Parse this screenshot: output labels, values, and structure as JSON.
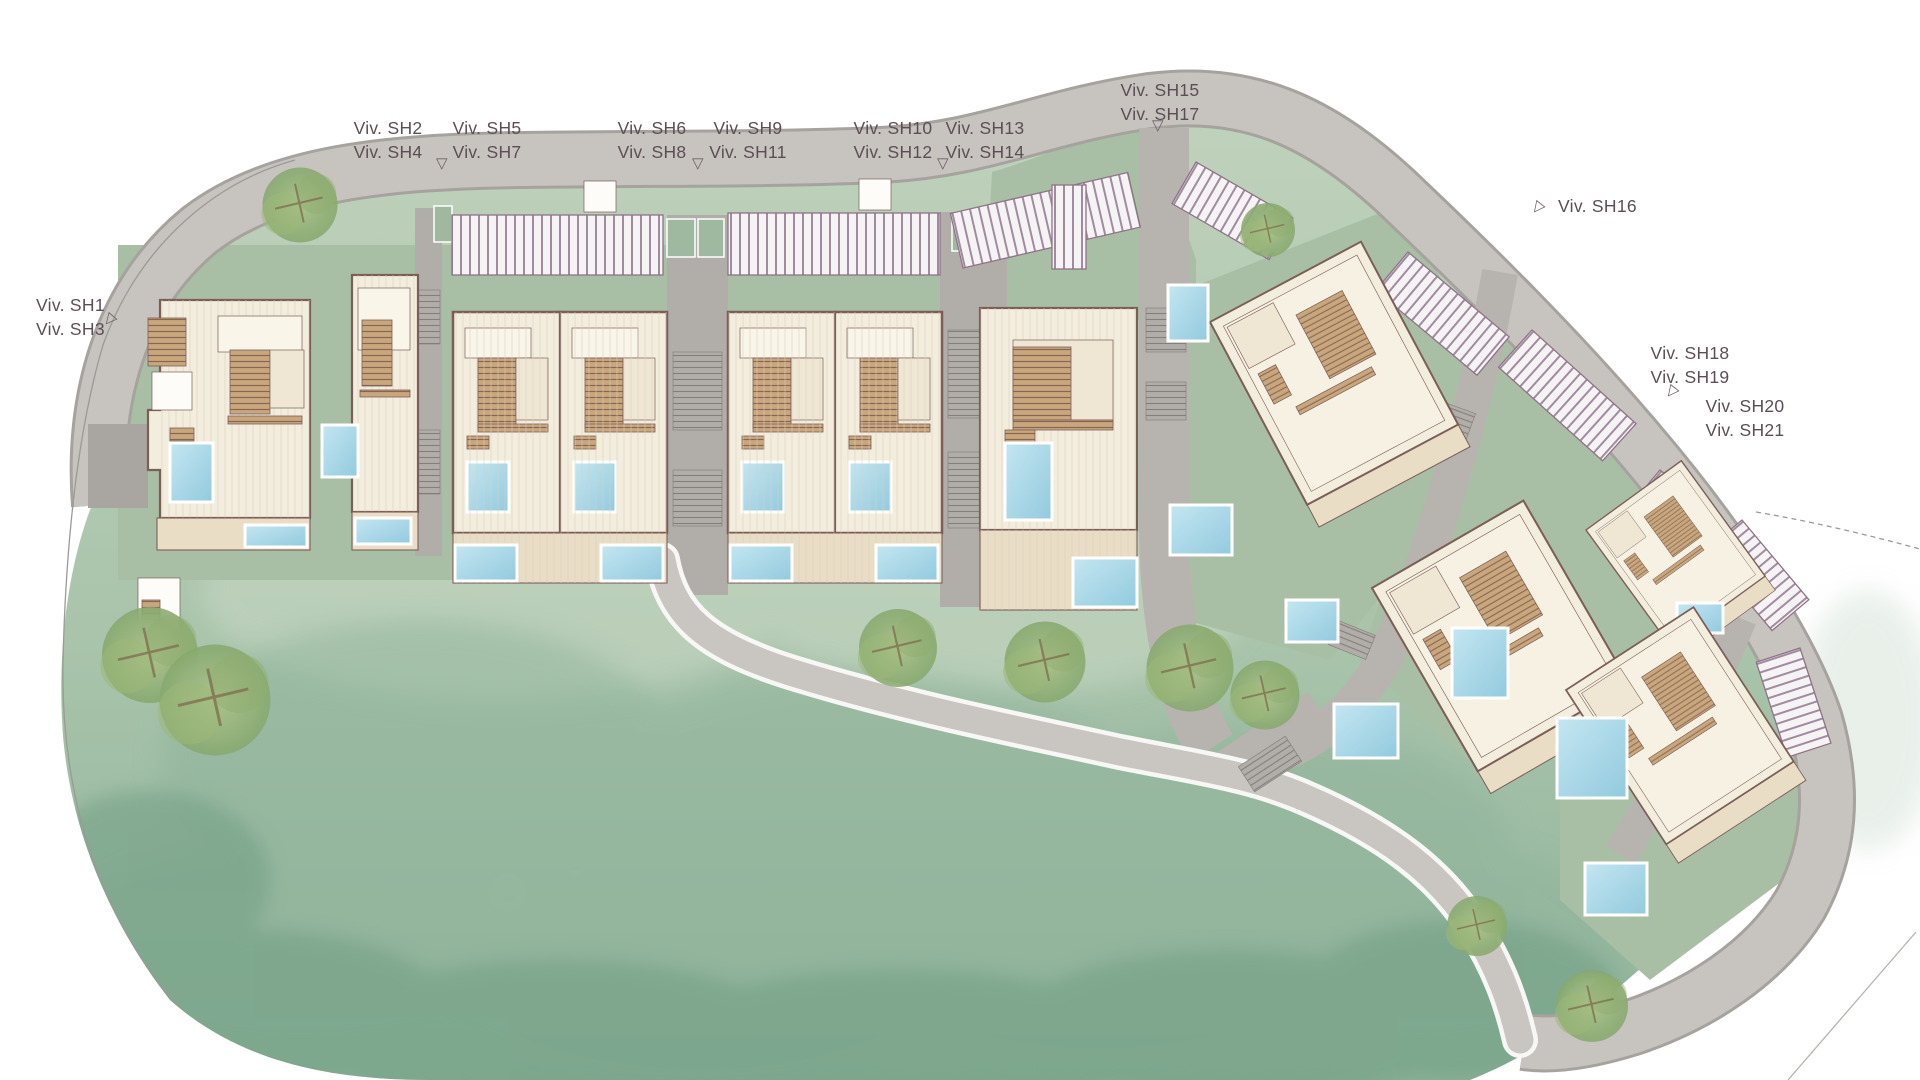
{
  "labels": {
    "sh1_3": {
      "line1": "Viv. SH1",
      "line2": "Viv. SH3"
    },
    "sh2_4": {
      "line1": "Viv. SH2",
      "line2": "Viv. SH4"
    },
    "sh5_7": {
      "line1": "Viv. SH5",
      "line2": "Viv. SH7"
    },
    "sh6_8": {
      "line1": "Viv. SH6",
      "line2": "Viv. SH8"
    },
    "sh9_11": {
      "line1": "Viv. SH9",
      "line2": "Viv. SH11"
    },
    "sh10_12": {
      "line1": "Viv. SH10",
      "line2": "Viv. SH12"
    },
    "sh13_14": {
      "line1": "Viv. SH13",
      "line2": "Viv. SH14"
    },
    "sh15_17": {
      "line1": "Viv. SH15",
      "line2": "Viv. SH17"
    },
    "sh16": {
      "line1": "Viv. SH16"
    },
    "sh18_19": {
      "line1": "Viv. SH18",
      "line2": "Viv. SH19"
    },
    "sh20_21": {
      "line1": "Viv. SH20",
      "line2": "Viv. SH21"
    }
  },
  "marker_glyph": "▽",
  "colors": {
    "background": "#ffffff",
    "label_text": "#5c4e56",
    "lawn_light": "#c0d2bc",
    "lawn_dark": "#8fb49a",
    "wash_dark": "#6d9b82",
    "road": "#c7c3be",
    "road_edge": "#a6a39e",
    "lane_gray": "#b7b3ae",
    "plot_green": "#a8bfa5",
    "building_fill": "#f3edde",
    "building_outline": "#7c5e59",
    "terrace": "#e9ddc5",
    "deck_fill": "#c9a77d",
    "deck_stripe": "#8a6553",
    "pergola_fill": "#f6f3f5",
    "pergola_line": "#a18ba0",
    "pool_blue": "#a6d7e8",
    "tree_green": "#94b27c",
    "boundary": "#9a9a96"
  }
}
